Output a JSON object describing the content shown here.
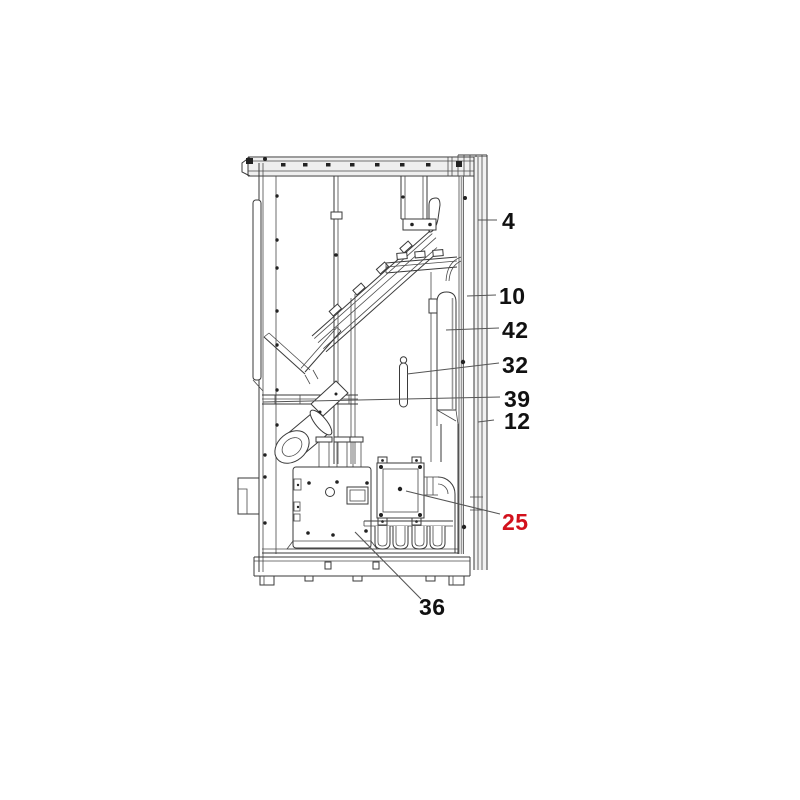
{
  "figure": {
    "kind": "exploded-parts-line-diagram",
    "subject": "stove side cross-section with numbered part callouts",
    "callouts": [
      {
        "id": "4",
        "label": "4",
        "highlighted": false
      },
      {
        "id": "10",
        "label": "10",
        "highlighted": false
      },
      {
        "id": "42",
        "label": "42",
        "highlighted": false
      },
      {
        "id": "32",
        "label": "32",
        "highlighted": false
      },
      {
        "id": "39",
        "label": "39",
        "highlighted": false
      },
      {
        "id": "12",
        "label": "12",
        "highlighted": false
      },
      {
        "id": "25",
        "label": "25",
        "highlighted": true
      },
      {
        "id": "36",
        "label": "36",
        "highlighted": false
      }
    ],
    "colors": {
      "line": "#3a3a3a",
      "label_text": "#111111",
      "highlight_text": "#d2111c",
      "background": "#ffffff"
    }
  }
}
